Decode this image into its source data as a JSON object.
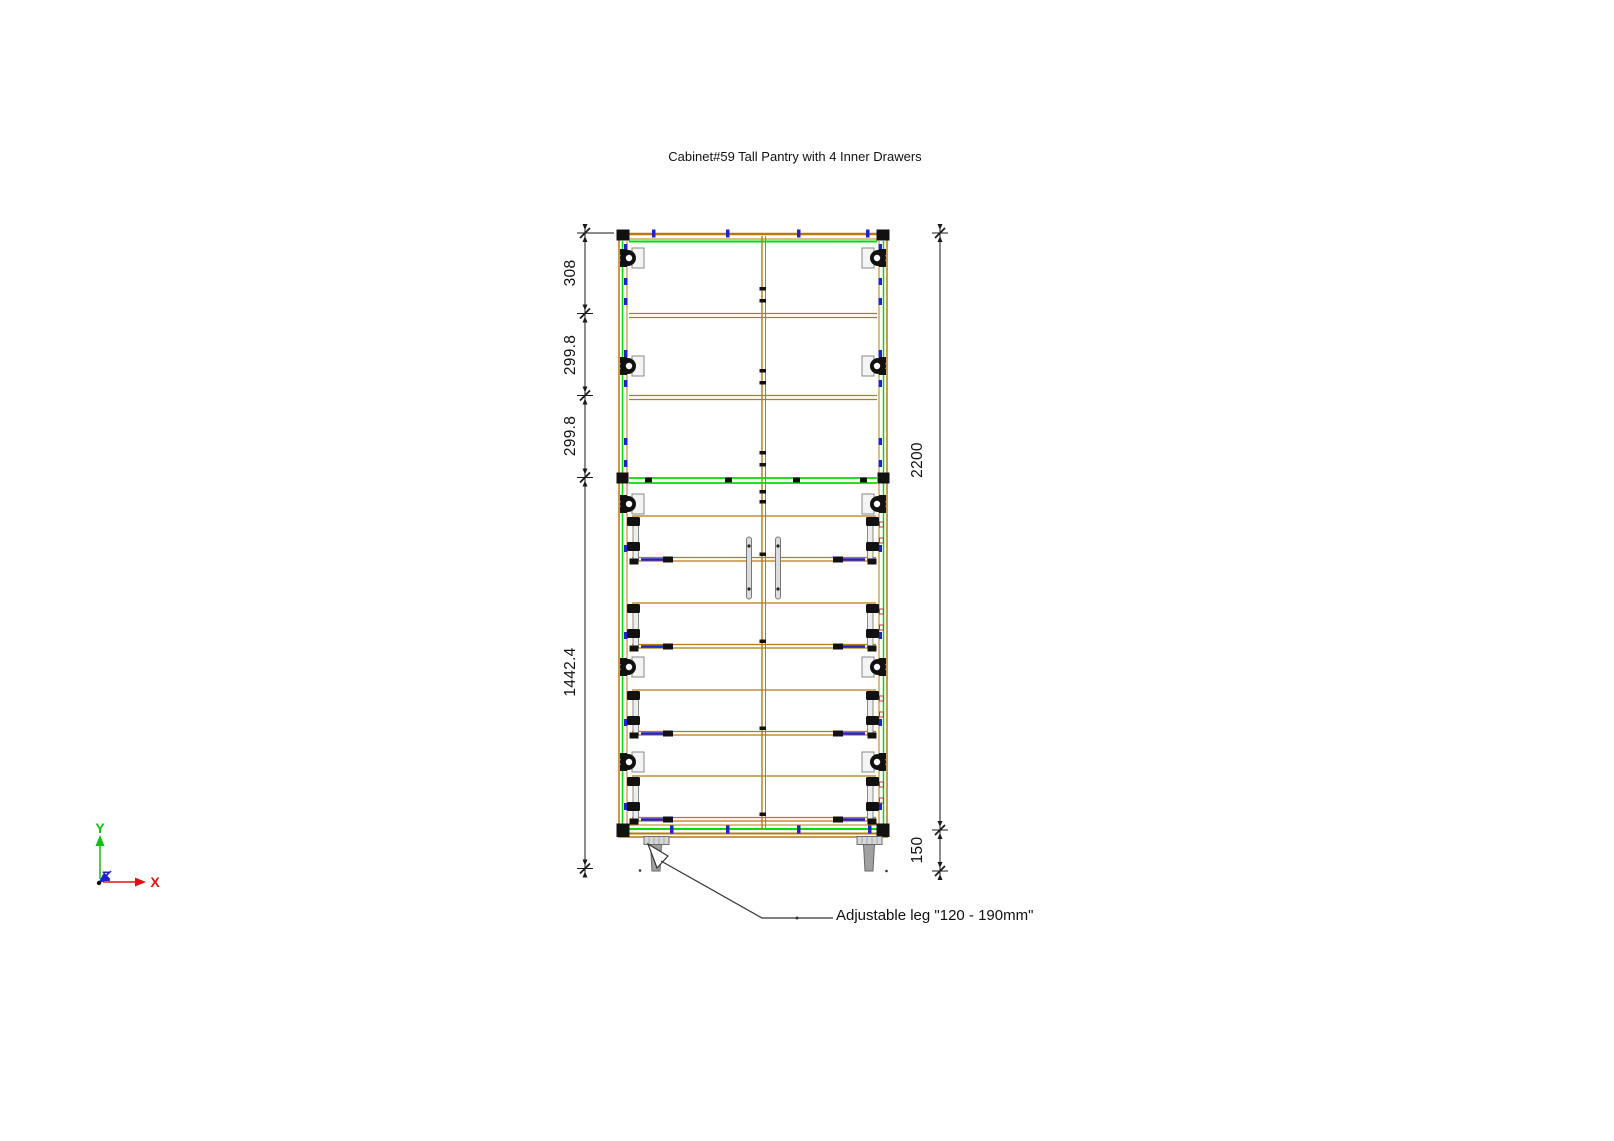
{
  "title": "Cabinet#59 Tall Pantry with 4 Inner Drawers",
  "drawing": {
    "dimensions": {
      "left": [
        {
          "label": "308"
        },
        {
          "label": "299.8"
        },
        {
          "label": "299.8"
        },
        {
          "label": "1442.4"
        }
      ],
      "right": [
        {
          "label": "2200"
        },
        {
          "label": "150"
        }
      ]
    },
    "annotations": [
      {
        "label": "Adjustable leg \"120 - 190mm\""
      }
    ],
    "axis_triad": {
      "x": "X",
      "y": "Y",
      "z": "Z"
    }
  },
  "colors": {
    "panel_edge_brown": "#b8790f",
    "board_green": "#00dd00",
    "fastener_blue": "#2222cc",
    "hardware_black": "#111111",
    "hardware_red": "#cc3333",
    "leg_gray": "#a0a0a0",
    "dimension_ink": "#1a1a1a",
    "axis_x_red": "#e01010",
    "axis_y_green": "#10c010",
    "axis_z_blue": "#2020d0"
  }
}
